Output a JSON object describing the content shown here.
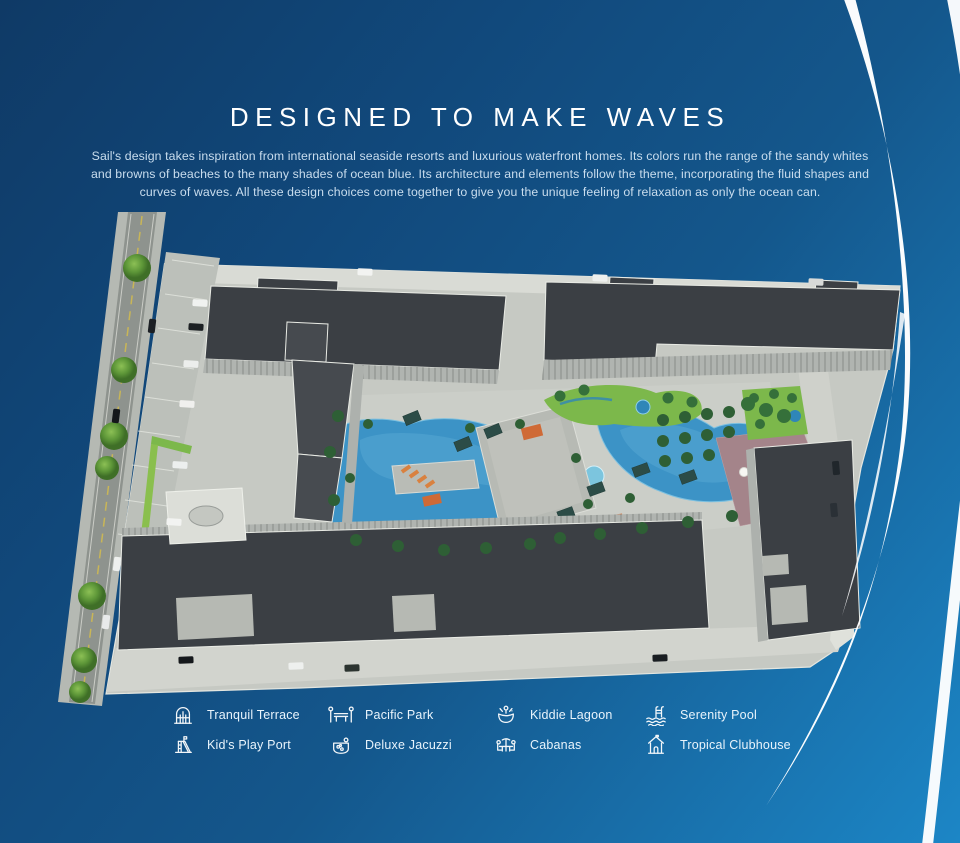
{
  "title": "DESIGNED TO MAKE WAVES",
  "description": "Sail's design takes inspiration from international seaside resorts and luxurious waterfront homes. Its colors run the range of the sandy whites and browns of beaches to the many shades of ocean blue. Its architecture and elements follow the theme, incorporating the fluid shapes and curves of waves. All these design choices come together to give you the unique feeling of relaxation as only the ocean can.",
  "legend": {
    "items": [
      {
        "label": "Tranquil Terrace",
        "icon": "tranquil-terrace-icon"
      },
      {
        "label": "Pacific Park",
        "icon": "pacific-park-icon"
      },
      {
        "label": "Kiddie Lagoon",
        "icon": "kiddie-lagoon-icon"
      },
      {
        "label": "Serenity Pool",
        "icon": "serenity-pool-icon"
      },
      {
        "label": "Kid's Play Port",
        "icon": "kids-play-port-icon"
      },
      {
        "label": "Deluxe Jacuzzi",
        "icon": "deluxe-jacuzzi-icon"
      },
      {
        "label": "Cabanas",
        "icon": "cabanas-icon"
      },
      {
        "label": "Tropical Clubhouse",
        "icon": "tropical-clubhouse-icon"
      }
    ]
  },
  "colors": {
    "bg_top": "#0f3a66",
    "bg_mid": "#14578c",
    "bg_bottom": "#1c86c6",
    "swoosh": "#ffffff",
    "text": "#ffffff",
    "paragraph": "#c9ddee",
    "roof": "#3b3f44",
    "podium": "#c6c9c3",
    "pool": "#3c93c6",
    "pool_light": "#55a8d3",
    "greenery": "#7cb84b",
    "palm": "#2e5f35",
    "orange": "#cf6a36",
    "sun_deck": "#a4848a",
    "road": "#8e938e",
    "sidewalk": "#d9dbd5"
  }
}
